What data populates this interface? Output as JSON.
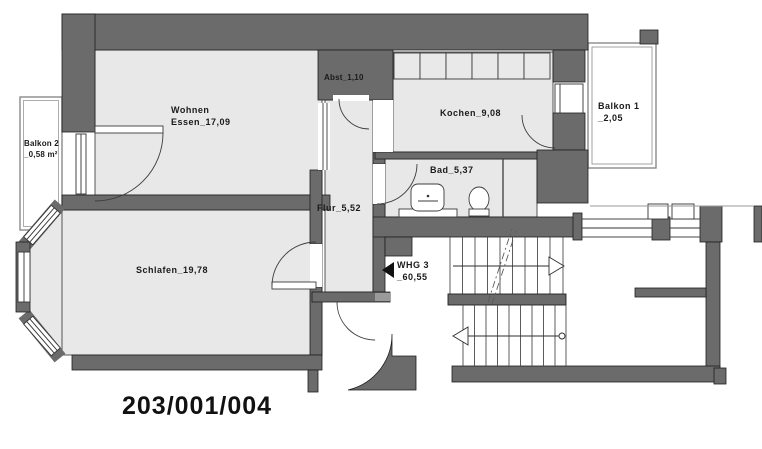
{
  "plan": {
    "number": "203/001/004",
    "rooms": {
      "wohnen": {
        "line1": "Wohnen",
        "line2": "Essen_17,09"
      },
      "abst": {
        "label": "Abst_1,10"
      },
      "kochen": {
        "label": "Kochen_9,08"
      },
      "bad": {
        "label": "Bad_5,37"
      },
      "flur": {
        "label": "Flur_5,52"
      },
      "schlafen": {
        "label": "Schlafen_19,78"
      },
      "balkon1": {
        "line1": "Balkon 1",
        "line2": "_2,05"
      },
      "balkon2": {
        "line1": "Balkon 2",
        "line2": "_0,58 m²"
      },
      "whg": {
        "line1": "WHG 3",
        "line2": "_60,55"
      }
    },
    "colors": {
      "wall": "#6b6b6b",
      "room_fill": "#e8e8e8",
      "outline": "#1f1f1f",
      "balcony_outline": "#8a8a8a"
    }
  }
}
